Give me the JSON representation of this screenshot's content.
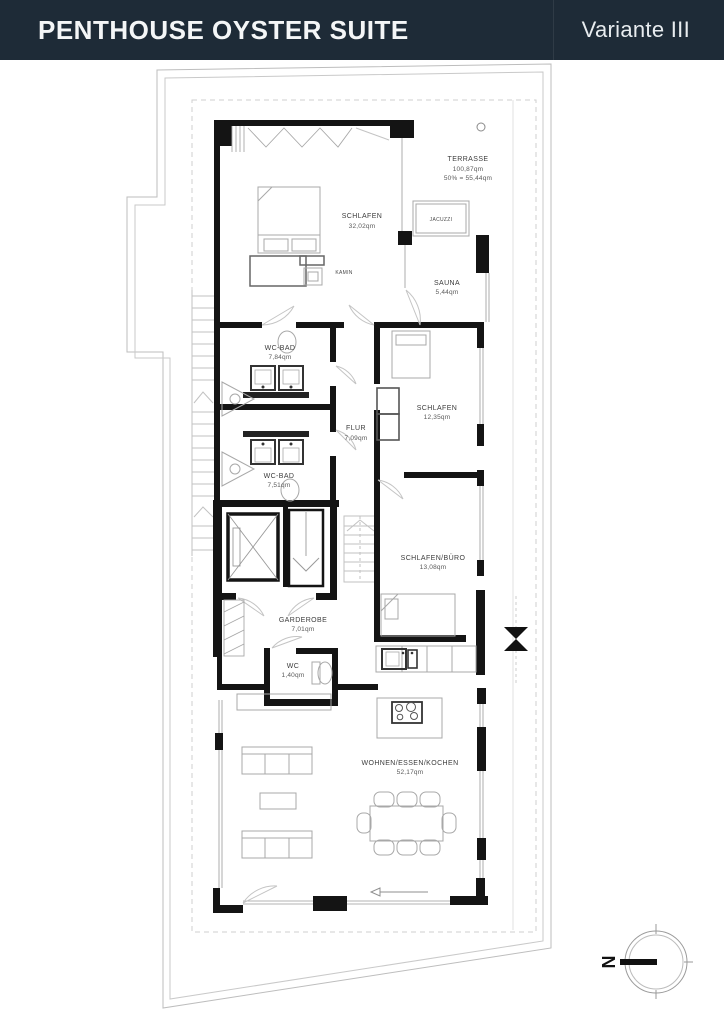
{
  "header": {
    "title": "PENTHOUSE OYSTER SUITE",
    "variant": "Variante III"
  },
  "rooms": [
    {
      "id": "terrasse",
      "name": "TERRASSE",
      "area": "100,87qm",
      "note": "50% = 55,44qm"
    },
    {
      "id": "schlafen-master",
      "name": "SCHLAFEN",
      "area": "32,02qm"
    },
    {
      "id": "jacuzzi",
      "name": "JACUZZI"
    },
    {
      "id": "kamin",
      "name": "KAMIN"
    },
    {
      "id": "sauna",
      "name": "SAUNA",
      "area": "5,44qm"
    },
    {
      "id": "wc-bad-1",
      "name": "WC-BAD",
      "area": "7,84qm"
    },
    {
      "id": "flur",
      "name": "FLUR",
      "area": "7,09qm"
    },
    {
      "id": "schlafen-2",
      "name": "SCHLAFEN",
      "area": "12,35qm"
    },
    {
      "id": "wc-bad-2",
      "name": "WC-BAD",
      "area": "7,51qm"
    },
    {
      "id": "schlafen-buero",
      "name": "SCHLAFEN/BÜRO",
      "area": "13,08qm"
    },
    {
      "id": "garderobe",
      "name": "GARDEROBE",
      "area": "7,01qm"
    },
    {
      "id": "wc",
      "name": "WC",
      "area": "1,40qm"
    },
    {
      "id": "wohnen",
      "name": "WOHNEN/ESSEN/KOCHEN",
      "area": "52,17qm"
    }
  ],
  "compass": {
    "label": "N"
  },
  "colors": {
    "header_bg": "#1e2b37",
    "wall": "#141414",
    "boundary": "#bdbdbd",
    "furniture": "#a8a8a8",
    "text": "#3c3c3c"
  }
}
